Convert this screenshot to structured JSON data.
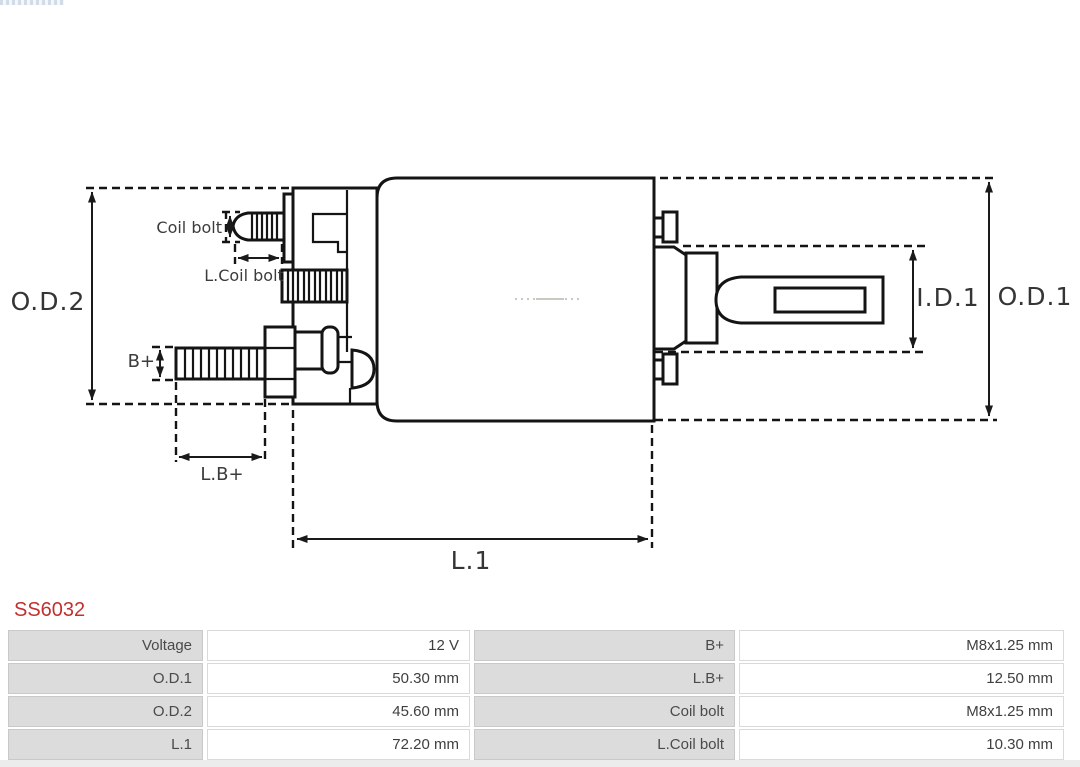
{
  "part_number": "SS6032",
  "diagram": {
    "labels": {
      "od2": "O.D.2",
      "od1": "O.D.1",
      "id1": "I.D.1",
      "l1": "L.1",
      "coil_bolt": "Coil bolt",
      "l_coil_bolt": "L.Coil bolt",
      "b_plus": "B+",
      "l_b_plus": "L.B+"
    }
  },
  "specs_table": {
    "rows": [
      {
        "label1": "Voltage",
        "value1": "12 V",
        "label2": "B+",
        "value2": "M8x1.25 mm"
      },
      {
        "label1": "O.D.1",
        "value1": "50.30 mm",
        "label2": "L.B+",
        "value2": "12.50 mm"
      },
      {
        "label1": "O.D.2",
        "value1": "45.60 mm",
        "label2": "Coil bolt",
        "value2": "M8x1.25 mm"
      },
      {
        "label1": "L.1",
        "value1": "72.20 mm",
        "label2": "L.Coil bolt",
        "value2": "10.30 mm"
      }
    ]
  },
  "colors": {
    "part_number_red": "#c0312f",
    "table_label_bg": "#dcdcdc",
    "drawing_line": "#141414"
  }
}
